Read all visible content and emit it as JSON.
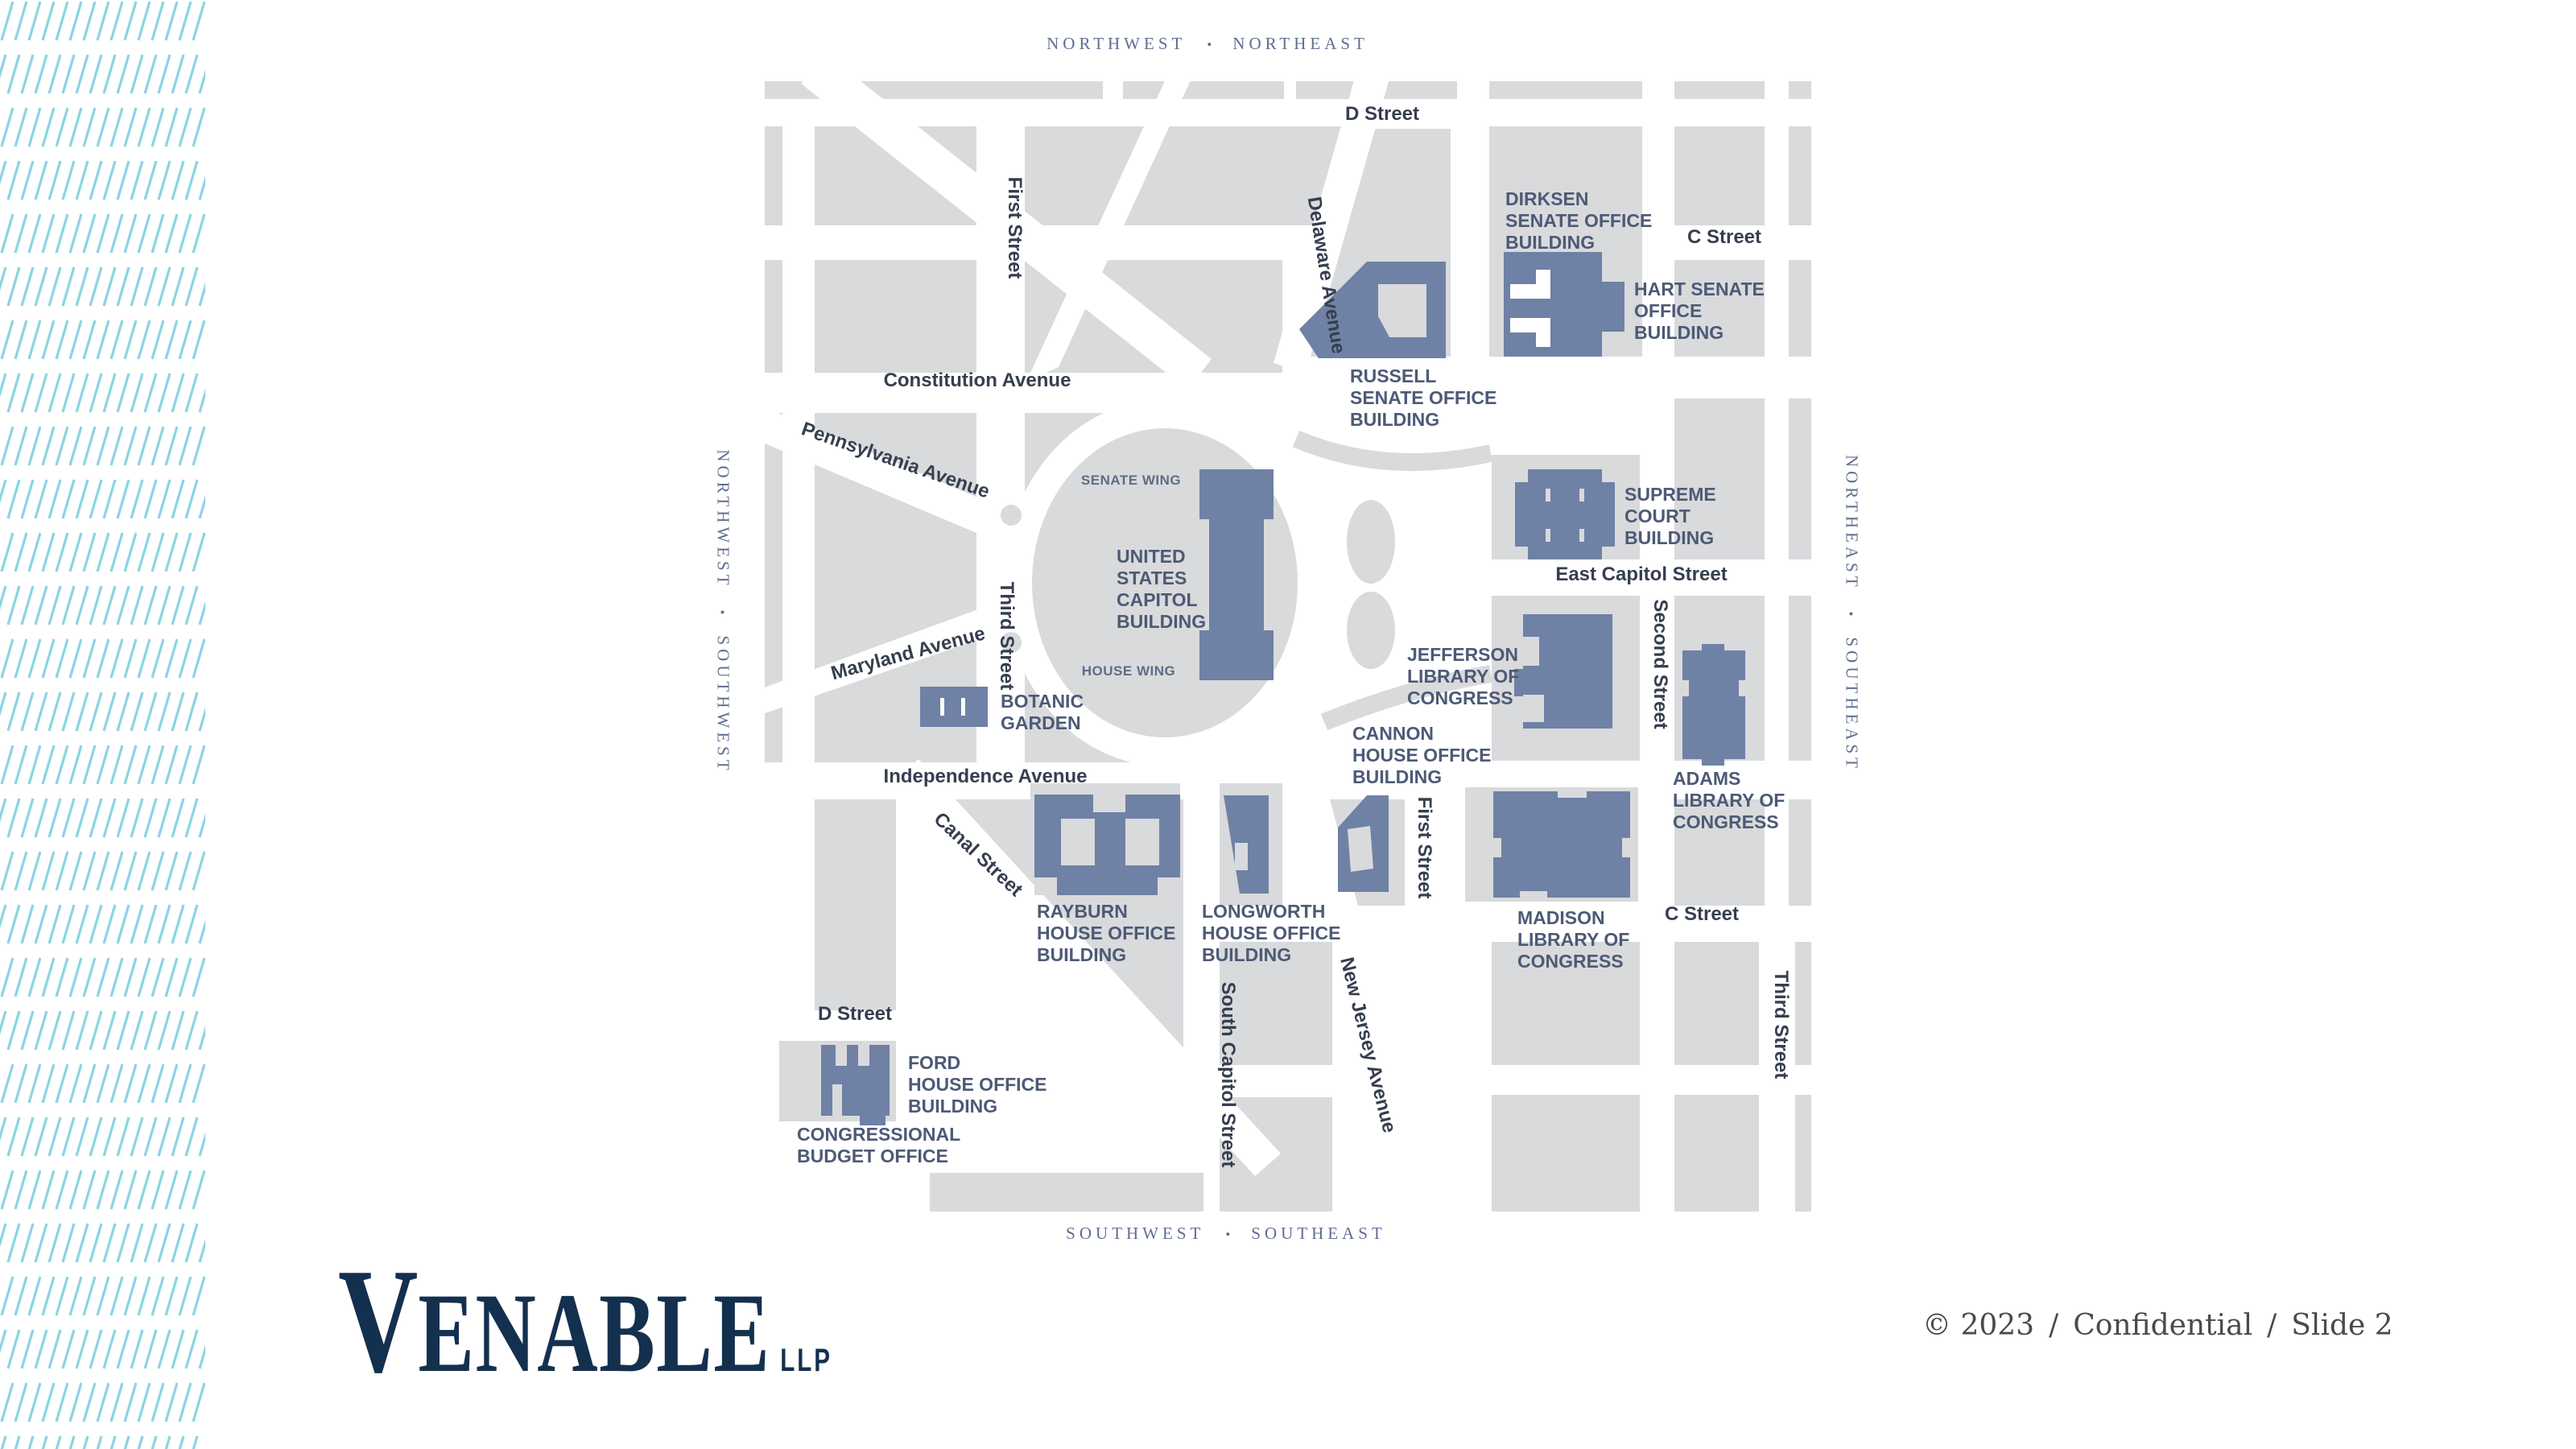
{
  "compass": {
    "nw": "NORTHWEST",
    "ne": "NORTHEAST",
    "sw": "SOUTHWEST",
    "se": "SOUTHEAST",
    "sep": "•"
  },
  "colors": {
    "building": "#6f81a5",
    "block": "#d9dadc",
    "hatch": "#8bd4e2",
    "building_label": "#4d5a76",
    "street_label": "#363e4f",
    "logo_navy": "#14304f"
  },
  "map": {
    "streets": [
      "D Street",
      "C Street",
      "Constitution Avenue",
      "Pennsylvania Avenue",
      "First Street",
      "Delaware Avenue",
      "Third Street",
      "Maryland Avenue",
      "Independence Avenue",
      "East Capitol Street",
      "Second Street",
      "First Street",
      "Canal Street",
      "South Capitol Street",
      "New Jersey Avenue",
      "C Street",
      "D Street",
      "Third Street"
    ],
    "buildings": [
      [
        "DIRKSEN",
        "SENATE OFFICE",
        "BUILDING"
      ],
      [
        "HART SENATE",
        "OFFICE",
        "BUILDING"
      ],
      [
        "RUSSELL",
        "SENATE OFFICE",
        "BUILDING"
      ],
      [
        "SUPREME",
        "COURT",
        "BUILDING"
      ],
      [
        "UNITED",
        "STATES",
        "CAPITOL",
        "BUILDING"
      ],
      [
        "SENATE WING"
      ],
      [
        "HOUSE WING"
      ],
      [
        "BOTANIC",
        "GARDEN"
      ],
      [
        "JEFFERSON",
        "LIBRARY OF",
        "CONGRESS"
      ],
      [
        "ADAMS",
        "LIBRARY OF",
        "CONGRESS"
      ],
      [
        "CANNON",
        "HOUSE OFFICE",
        "BUILDING"
      ],
      [
        "RAYBURN",
        "HOUSE OFFICE",
        "BUILDING"
      ],
      [
        "LONGWORTH",
        "HOUSE OFFICE",
        "BUILDING"
      ],
      [
        "MADISON",
        "LIBRARY OF",
        "CONGRESS"
      ],
      [
        "FORD",
        "HOUSE OFFICE",
        "BUILDING"
      ],
      [
        "CONGRESSIONAL",
        "BUDGET OFFICE"
      ]
    ]
  },
  "footer": {
    "logo_initial": "V",
    "logo_rest": "ENABLE",
    "logo_llp": "LLP",
    "copyright": "© 2023",
    "sep": "/",
    "confidential": "Confidential",
    "slide": "Slide 2"
  }
}
